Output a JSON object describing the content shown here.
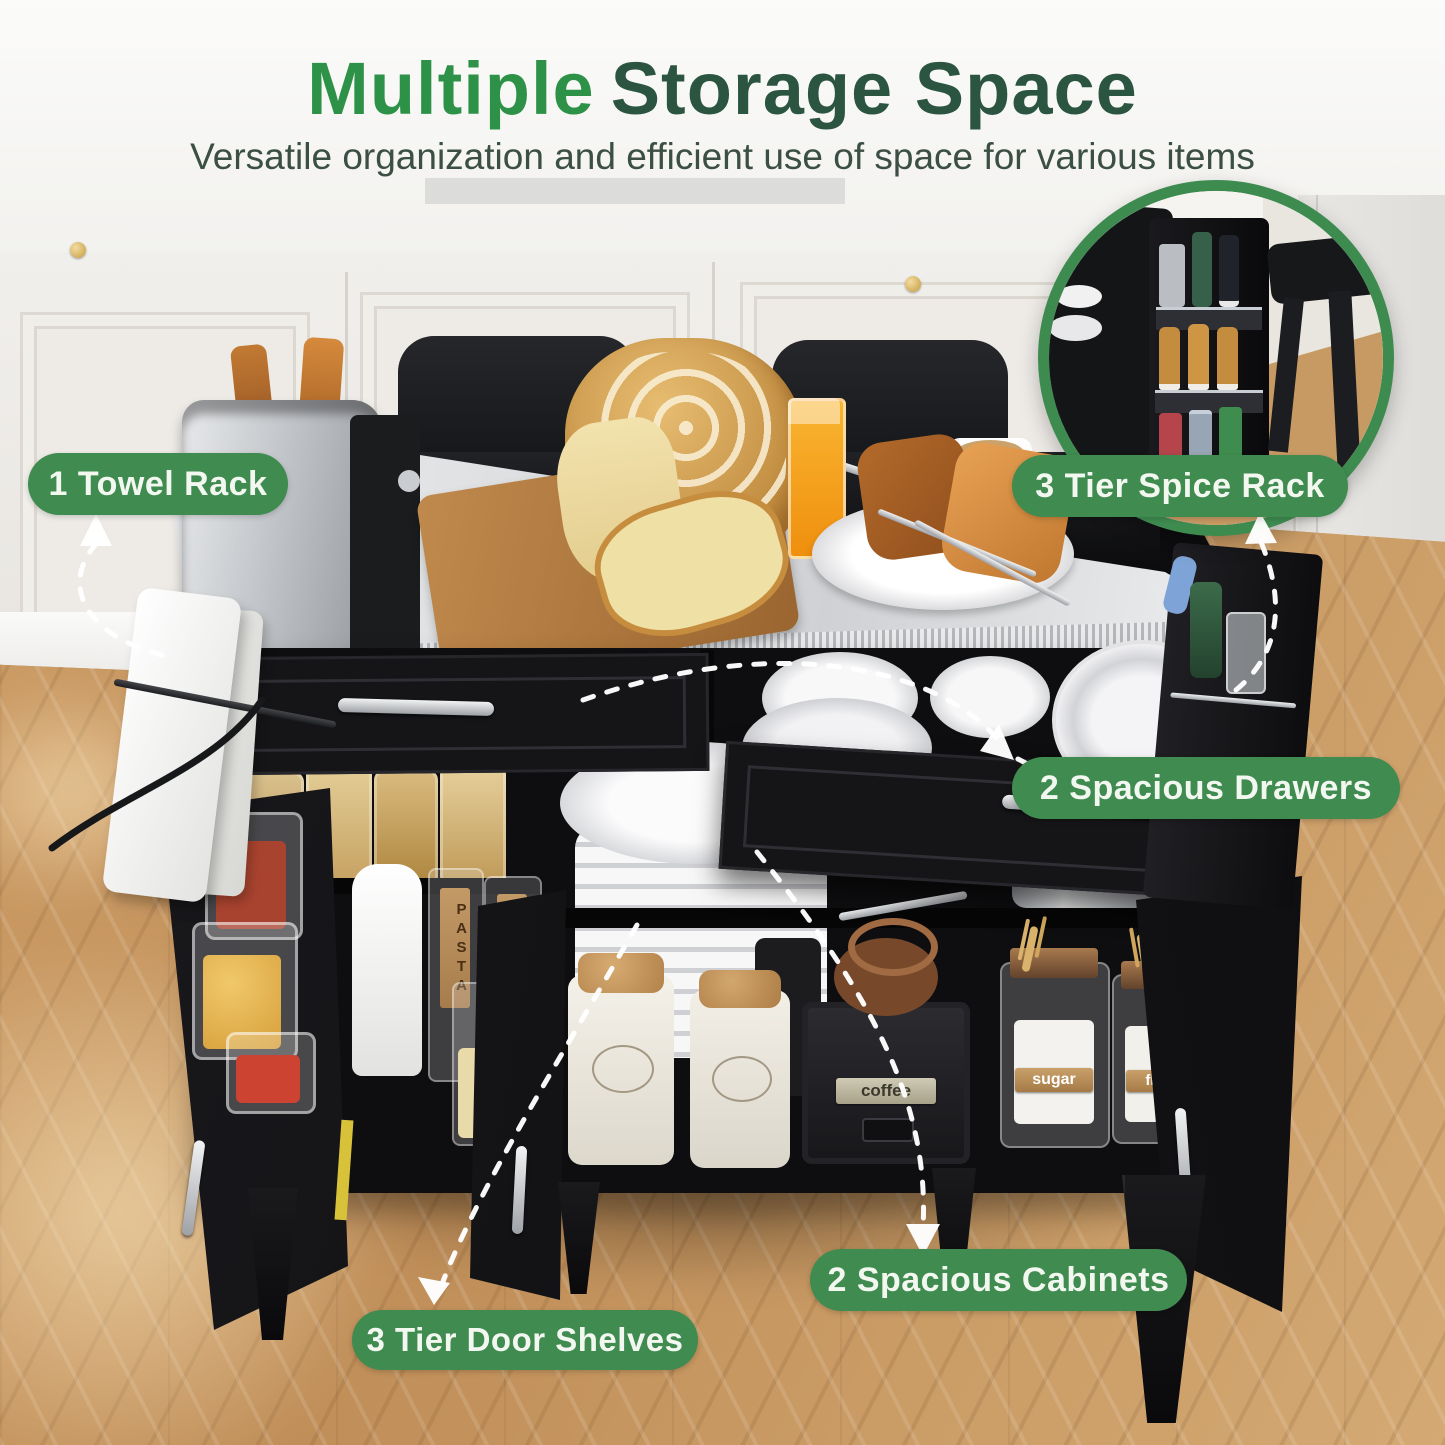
{
  "header": {
    "title_accent": "Multiple",
    "title_rest": "Storage Space",
    "subtitle": "Versatile organization and efficient use of space for various items"
  },
  "callouts": [
    {
      "id": "towel-rack",
      "label": "1 Towel Rack"
    },
    {
      "id": "spice-rack",
      "label": "3 Tier Spice Rack"
    },
    {
      "id": "spacious-drawers",
      "label": "2 Spacious Drawers"
    },
    {
      "id": "spacious-cabinets",
      "label": "2 Spacious Cabinets"
    },
    {
      "id": "door-shelves",
      "label": "3 Tier Door Shelves"
    }
  ],
  "scene_text": {
    "coffee_grinder_label": "coffee",
    "sugar_canister_label": "sugar",
    "flour_canister_label": "flour",
    "pasta_jar_label": "PASTA"
  },
  "colors": {
    "title_accent_green": "#2E9148",
    "title_dark_green": "#2B5441",
    "subtitle_green": "#3B4F44",
    "badge_green": "#3F8B50",
    "badge_text": "#F2F7F0",
    "inset_ring_green": "#3E8B50",
    "arrow_white": "#FFFFFF",
    "floor_wood": "#C6975F",
    "island_black": "#121214",
    "steel_top": "#D9DADC"
  }
}
